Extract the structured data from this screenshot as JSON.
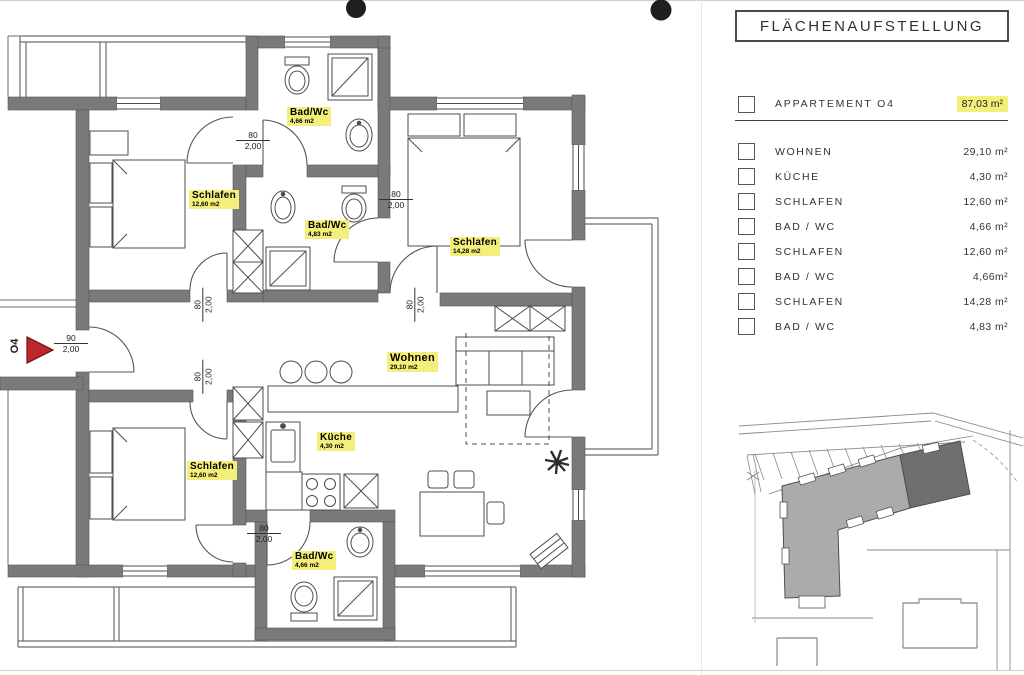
{
  "legend": {
    "title": "FLÄCHENAUFSTELLUNG",
    "apartment": {
      "label": "APPARTEMENT  O4",
      "area": "87,03 m²"
    },
    "rows": [
      {
        "label": "WOHNEN",
        "area": "29,10 m²"
      },
      {
        "label": "KÜCHE",
        "area": "4,30 m²"
      },
      {
        "label": "SCHLAFEN",
        "area": "12,60 m²"
      },
      {
        "label": "BAD / WC",
        "area": "4,66 m²"
      },
      {
        "label": "SCHLAFEN",
        "area": "12,60 m²"
      },
      {
        "label": "BAD / WC",
        "area": "4,66m²"
      },
      {
        "label": "SCHLAFEN",
        "area": "14,28 m²"
      },
      {
        "label": "BAD / WC",
        "area": "4,83 m²"
      }
    ]
  },
  "plan": {
    "entrance_tag": "O4",
    "dims": {
      "door_width": "80",
      "entrance_width": "90",
      "door_height": "2,00"
    },
    "rooms": [
      {
        "name": "Schlafen",
        "area": "12,60 m2"
      },
      {
        "name": "Bad/Wc",
        "area": "4,66 m2"
      },
      {
        "name": "Bad/Wc",
        "area": "4,83 m2"
      },
      {
        "name": "Schlafen",
        "area": "14,28 m2"
      },
      {
        "name": "Wohnen",
        "area": "29,10 m2"
      },
      {
        "name": "Küche",
        "area": "4,30 m2"
      },
      {
        "name": "Schlafen",
        "area": "12,60 m2"
      },
      {
        "name": "Bad/Wc",
        "area": "4,66 m2"
      }
    ]
  },
  "colors": {
    "highlight_yellow": "#f4ef7a",
    "entrance_arrow_red": "#c0272d",
    "wall_gray": "#7a7a7a",
    "site_building_gray": "#ababab",
    "site_building_dark": "#6f6f6f"
  }
}
